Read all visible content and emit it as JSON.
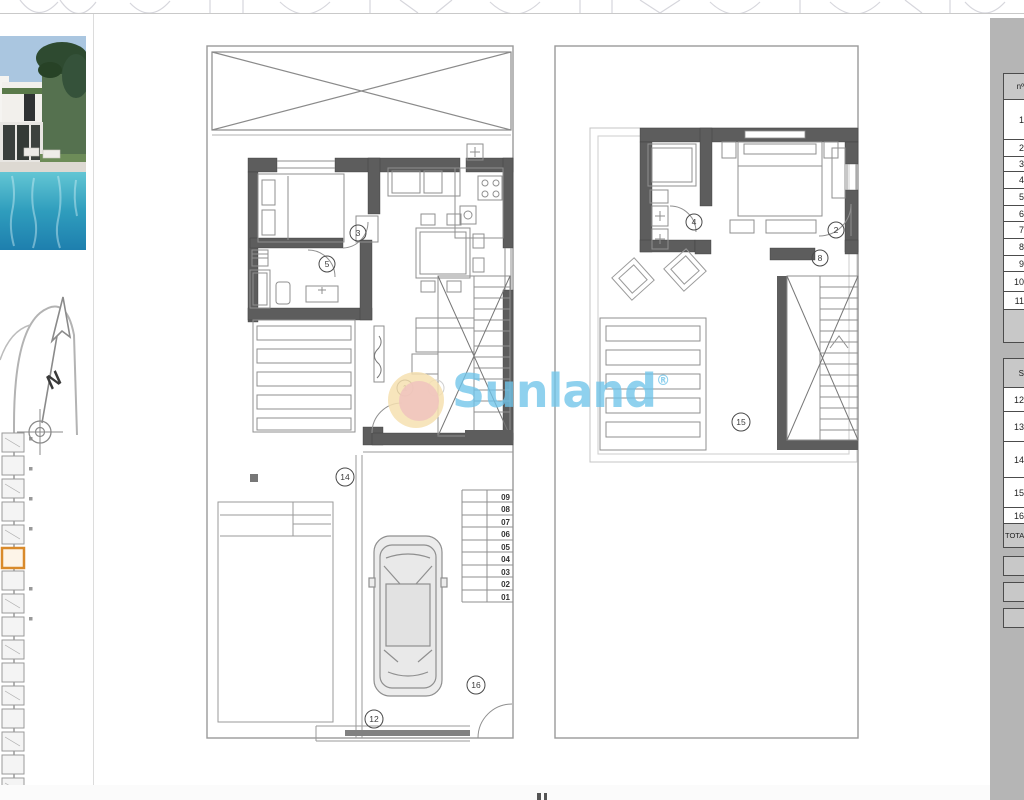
{
  "watermark": {
    "text": "Sunland",
    "reg": "®",
    "text_color": "#70c4e9",
    "sun_outer_color": "#f6e1b0",
    "sun_inner_color": "#f0c4be"
  },
  "compass": {
    "north_label": "N"
  },
  "plans": {
    "ground_floor": {
      "callouts": [
        "3",
        "5",
        "1",
        "14",
        "12",
        "16"
      ],
      "stair_steps": [
        "09",
        "08",
        "07",
        "06",
        "05",
        "04",
        "03",
        "02",
        "01"
      ]
    },
    "first_floor": {
      "callouts": [
        "4",
        "2",
        "8",
        "15"
      ]
    }
  },
  "side_table": {
    "header": "nº",
    "rows": [
      "1",
      "2",
      "3",
      "4",
      "5",
      "6",
      "7",
      "8",
      "9",
      "10",
      "11"
    ],
    "section2_header": "S",
    "rows2": [
      "12",
      "13",
      "14",
      "15",
      "16"
    ],
    "total_label": "TOTAL"
  },
  "site_plan": {
    "highlight_color": "#d98a2b"
  },
  "colors": {
    "wall": "#5d5d5d",
    "thin_line": "#8f8f8f",
    "boundary": "#9a9a9a",
    "panel_gray": "#b5b5b5",
    "pool_blue": "#2f9dbd"
  }
}
